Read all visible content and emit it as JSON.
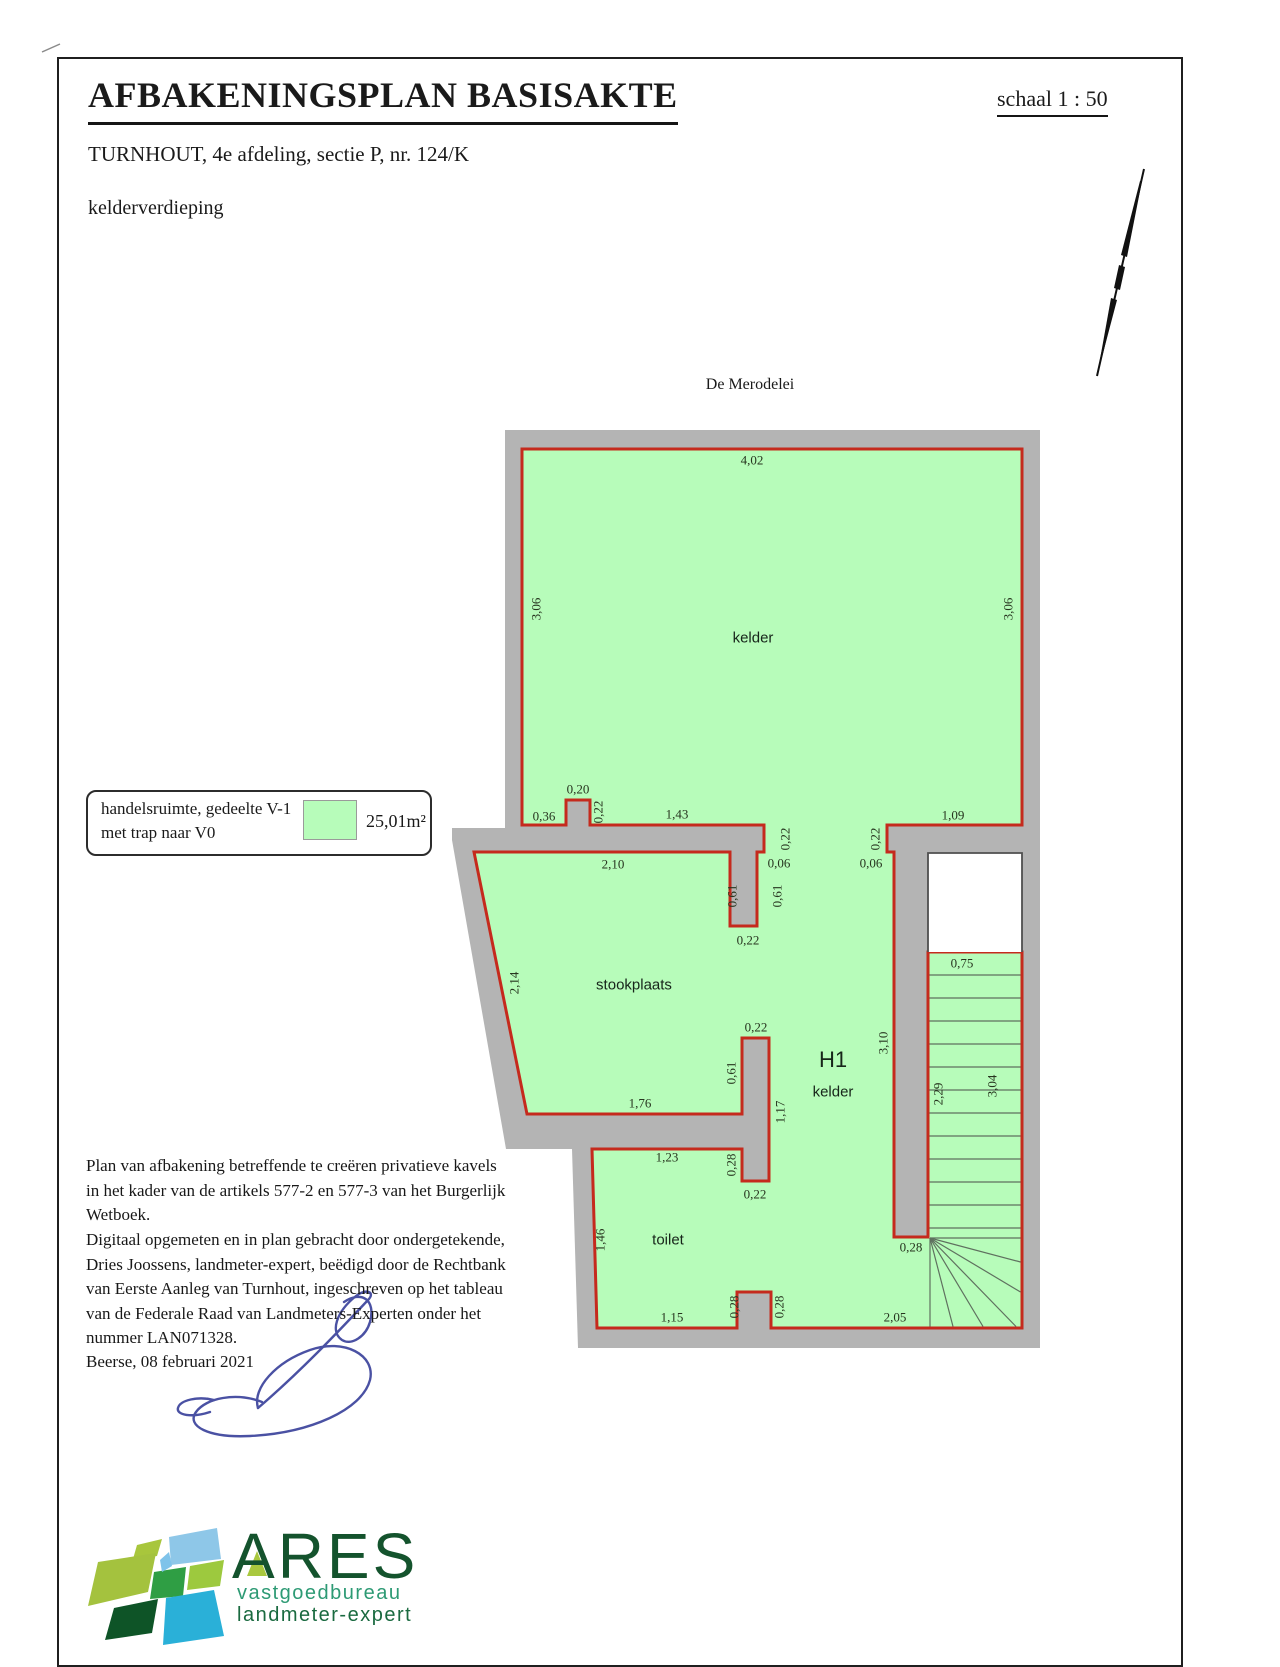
{
  "colors": {
    "parcel_green": "#b7fcba",
    "wall_grey": "#b4b4b4",
    "boundary_red": "#c52a1d",
    "signature_blue": "#4a51a3",
    "logo_dark_green": "#14532d",
    "logo_teal_green": "#2d9a74"
  },
  "header": {
    "title": "AFBAKENINGSPLAN BASISAKTE",
    "scale": "schaal   1 : 50",
    "subtitle": "TURNHOUT, 4e afdeling, sectie P, nr. 124/K",
    "floor": "kelderverdieping"
  },
  "plan": {
    "street": "De Merodelei",
    "dimensions": [
      {
        "t": "4,02",
        "x": 752,
        "y": 460
      },
      {
        "t": "3,06",
        "x": 536,
        "y": 609,
        "r": 1
      },
      {
        "t": "3,06",
        "x": 1008,
        "y": 609,
        "r": 1
      },
      {
        "t": "kelder",
        "x": 753,
        "y": 638,
        "cls": "room"
      },
      {
        "t": "0,20",
        "x": 578,
        "y": 789
      },
      {
        "t": "0,36",
        "x": 544,
        "y": 816
      },
      {
        "t": "0,22",
        "x": 598,
        "y": 812,
        "r": 1
      },
      {
        "t": "1,43",
        "x": 677,
        "y": 814
      },
      {
        "t": "0,22",
        "x": 785,
        "y": 839,
        "r": 1
      },
      {
        "t": "0,06",
        "x": 779,
        "y": 863
      },
      {
        "t": "0,61",
        "x": 732,
        "y": 896,
        "r": 1
      },
      {
        "t": "0,61",
        "x": 777,
        "y": 896,
        "r": 1
      },
      {
        "t": "0,22",
        "x": 748,
        "y": 940
      },
      {
        "t": "1,09",
        "x": 953,
        "y": 815
      },
      {
        "t": "0,22",
        "x": 875,
        "y": 839,
        "r": 1
      },
      {
        "t": "0,06",
        "x": 871,
        "y": 863
      },
      {
        "t": "2,10",
        "x": 613,
        "y": 864
      },
      {
        "t": "2,14",
        "x": 514,
        "y": 983,
        "r": 1
      },
      {
        "t": "stookplaats",
        "x": 634,
        "y": 985,
        "cls": "room"
      },
      {
        "t": "0,22",
        "x": 756,
        "y": 1027
      },
      {
        "t": "0,61",
        "x": 731,
        "y": 1073,
        "r": 1
      },
      {
        "t": "1,17",
        "x": 780,
        "y": 1112,
        "r": 1
      },
      {
        "t": "H1",
        "x": 833,
        "y": 1060,
        "cls": "room room-lg"
      },
      {
        "t": "kelder",
        "x": 833,
        "y": 1092,
        "cls": "room"
      },
      {
        "t": "3,10",
        "x": 883,
        "y": 1043,
        "r": 1
      },
      {
        "t": "0,75",
        "x": 962,
        "y": 963
      },
      {
        "t": "2,29",
        "x": 938,
        "y": 1094,
        "r": 1
      },
      {
        "t": "3,04",
        "x": 992,
        "y": 1086,
        "r": 1
      },
      {
        "t": "1,76",
        "x": 640,
        "y": 1103
      },
      {
        "t": "1,23",
        "x": 667,
        "y": 1157
      },
      {
        "t": "0,28",
        "x": 731,
        "y": 1165,
        "r": 1
      },
      {
        "t": "0,22",
        "x": 755,
        "y": 1194
      },
      {
        "t": "toilet",
        "x": 668,
        "y": 1240,
        "cls": "room"
      },
      {
        "t": "1,46",
        "x": 600,
        "y": 1240,
        "r": 1
      },
      {
        "t": "0,28",
        "x": 911,
        "y": 1247
      },
      {
        "t": "1,15",
        "x": 672,
        "y": 1317
      },
      {
        "t": "0,28",
        "x": 734,
        "y": 1307,
        "r": 1
      },
      {
        "t": "0,28",
        "x": 779,
        "y": 1307,
        "r": 1
      },
      {
        "t": "2,05",
        "x": 895,
        "y": 1317
      }
    ]
  },
  "legend": {
    "label": "handelsruimte, gedeelte V-1\nmet trap naar V0",
    "area": "25,01m²"
  },
  "notes": {
    "p1": "Plan van afbakening betreffende te creëren privatieve kavels\nin het kader van de artikels 577-2 en 577-3 van het Burgerlijk\nWetboek.",
    "p2": "Digitaal opgemeten en in plan gebracht door ondergetekende,\nDries Joossens, landmeter-expert, beëdigd door de Rechtbank\nvan Eerste Aanleg van Turnhout, ingeschreven op het tableau\nvan de Federale Raad van Landmeters-Experten onder het\nnummer LAN071328.",
    "date": "Beerse, 08 februari 2021"
  },
  "logo": {
    "name": "ARES",
    "sub1": "vastgoedbureau",
    "sub2": "landmeter-expert"
  }
}
